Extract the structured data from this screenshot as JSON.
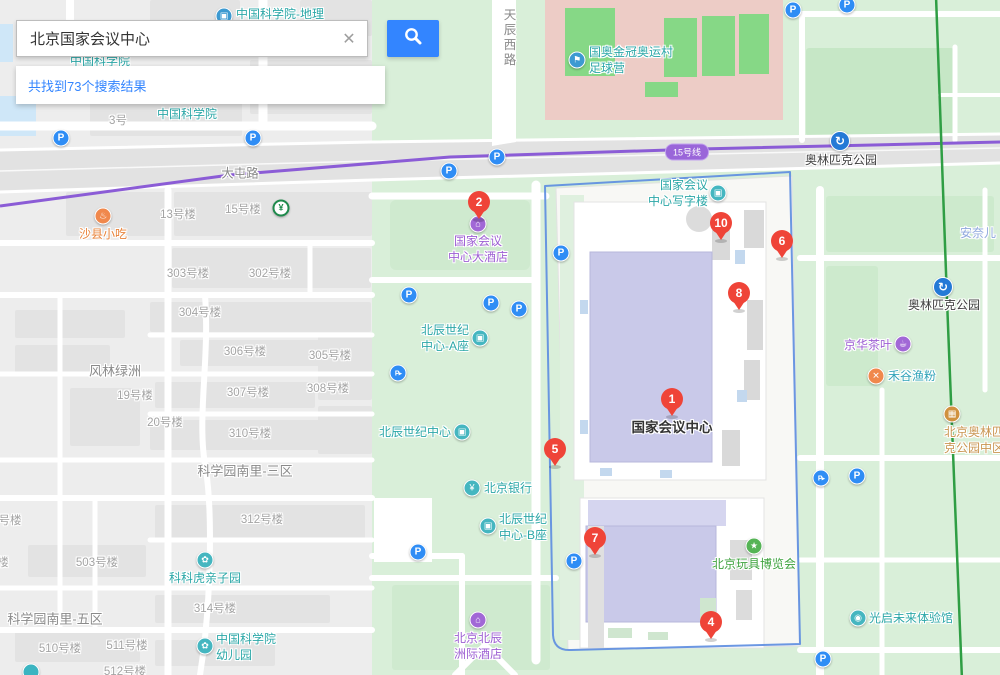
{
  "search": {
    "query": "北京国家会议中心",
    "clear_icon": "✕",
    "button_icon": "magnifier-icon",
    "results_text": "共找到73个搜索结果"
  },
  "map": {
    "subway_badge": "15号线",
    "colors": {
      "accent_blue": "#3385ff",
      "marker_red": "#ef4438",
      "parking_blue": "#2f8df5",
      "metro_blue": "#2479d6",
      "poi_teal": "#2ba7a7",
      "poi_purple": "#9d5fd3",
      "poi_orange": "#e8833a",
      "poi_green": "#3da23d",
      "subway_purple": "#8b5cd6",
      "boundary_blue": "#5b8ce0",
      "rail_green": "#2f9e44"
    },
    "markers": [
      {
        "label": "1",
        "x": 672,
        "y": 399
      },
      {
        "label": "2",
        "x": 479,
        "y": 202
      },
      {
        "label": "4",
        "x": 711,
        "y": 622
      },
      {
        "label": "5",
        "x": 555,
        "y": 449
      },
      {
        "label": "6",
        "x": 782,
        "y": 241
      },
      {
        "label": "7",
        "x": 595,
        "y": 538
      },
      {
        "label": "8",
        "x": 739,
        "y": 293
      },
      {
        "label": "10",
        "x": 721,
        "y": 223
      }
    ],
    "pois": [
      {
        "id": "cas-geography",
        "lines": [
          "中国科学院-地理"
        ],
        "icon": {
          "glyph": "▣",
          "bg": "#3d9ad1",
          "x": 224,
          "y": 16
        },
        "text": {
          "x": 236,
          "y": 14,
          "align": "right",
          "color": "#2ba7a7"
        }
      },
      {
        "id": "cas-institute",
        "lines": [
          "中国科学院"
        ],
        "text": {
          "x": 187,
          "y": 114,
          "align": "center",
          "color": "#2ba7a7"
        }
      },
      {
        "id": "cas-institute-partial",
        "lines": [
          "中国科学院"
        ],
        "text": {
          "x": 100,
          "y": 61,
          "align": "center",
          "color": "#2ba7a7"
        }
      },
      {
        "id": "guoao-soccer-camp",
        "lines": [
          "国奥金冠奥运村",
          "足球营"
        ],
        "icon": {
          "glyph": "⚑",
          "bg": "#3d9ad1",
          "x": 577,
          "y": 60
        },
        "text": {
          "x": 589,
          "y": 60,
          "align": "right",
          "color": "#2ba7a7"
        }
      },
      {
        "id": "olympic-park-station-nw",
        "lines": [
          "奥林匹克公园"
        ],
        "icon": {
          "glyph": "↻",
          "bg": "#2479d6",
          "x": 840,
          "y": 141,
          "metro": true
        },
        "text": {
          "x": 841,
          "y": 152,
          "align": "below",
          "color": "#3c3c3c"
        }
      },
      {
        "id": "olympic-park-station-se",
        "lines": [
          "奥林匹克公园"
        ],
        "icon": {
          "glyph": "↻",
          "bg": "#2479d6",
          "x": 943,
          "y": 287,
          "metro": true
        },
        "text": {
          "x": 944,
          "y": 297,
          "align": "below",
          "color": "#3c3c3c"
        }
      },
      {
        "id": "shaxian-snack",
        "lines": [
          "沙县小吃"
        ],
        "icon": {
          "glyph": "♨",
          "bg": "#f0884c",
          "x": 103,
          "y": 216
        },
        "text": {
          "x": 103,
          "y": 226,
          "align": "below",
          "color": "#e8833a"
        }
      },
      {
        "id": "abc-bank",
        "lines": [],
        "icon": {
          "glyph": "¥",
          "bg": "#fff",
          "x": 281,
          "y": 208,
          "ring": true
        }
      },
      {
        "id": "beichen-century-center-a",
        "lines": [
          "北辰世纪",
          "中心-A座"
        ],
        "icon": {
          "glyph": "▣",
          "bg": "#45b6c0",
          "x": 480,
          "y": 338
        },
        "text": {
          "x": 469,
          "y": 338,
          "align": "left",
          "color": "#2ba7a7"
        }
      },
      {
        "id": "beichen-century-center",
        "lines": [
          "北辰世纪中心"
        ],
        "icon": {
          "glyph": "▣",
          "bg": "#45b6c0",
          "x": 462,
          "y": 432
        },
        "text": {
          "x": 451,
          "y": 432,
          "align": "left",
          "color": "#2ba7a7"
        }
      },
      {
        "id": "bank-of-beijing",
        "lines": [
          "北京银行"
        ],
        "icon": {
          "glyph": "¥",
          "bg": "#45b6c0",
          "x": 472,
          "y": 488
        },
        "text": {
          "x": 484,
          "y": 488,
          "align": "right",
          "color": "#2ba7a7"
        }
      },
      {
        "id": "beichen-century-center-b",
        "lines": [
          "北辰世纪",
          "中心-B座"
        ],
        "icon": {
          "glyph": "▣",
          "bg": "#45b6c0",
          "x": 488,
          "y": 526
        },
        "text": {
          "x": 499,
          "y": 527,
          "align": "right",
          "color": "#2ba7a7"
        }
      },
      {
        "id": "ncc-grand-hotel",
        "lines": [
          "国家会议",
          "中心大酒店"
        ],
        "icon": {
          "glyph": "⌂",
          "bg": "#a168d6",
          "x": 478,
          "y": 224
        },
        "text": {
          "x": 478,
          "y": 233,
          "align": "below",
          "color": "#9d5fd3"
        }
      },
      {
        "id": "ncc-office-tower",
        "lines": [
          "国家会议",
          "中心写字楼"
        ],
        "icon": {
          "glyph": "▣",
          "bg": "#45b6c0",
          "x": 718,
          "y": 193
        },
        "text": {
          "x": 708,
          "y": 193,
          "align": "left",
          "color": "#2ba7a7"
        }
      },
      {
        "id": "ncc-main-label",
        "lines": [
          "国家会议中心"
        ],
        "text": {
          "x": 672,
          "y": 428,
          "align": "center",
          "color": "#333333",
          "size": 13.5,
          "weight": "bold"
        }
      },
      {
        "id": "intercontinental-hotel",
        "lines": [
          "北京北辰",
          "洲际酒店"
        ],
        "icon": {
          "glyph": "⌂",
          "bg": "#a168d6",
          "x": 478,
          "y": 620
        },
        "text": {
          "x": 478,
          "y": 630,
          "align": "below",
          "color": "#9d5fd3"
        }
      },
      {
        "id": "toy-expo",
        "lines": [
          "北京玩具博览会"
        ],
        "icon": {
          "glyph": "★",
          "bg": "#56b456",
          "x": 754,
          "y": 546
        },
        "text": {
          "x": 754,
          "y": 556,
          "align": "below",
          "color": "#3da23d"
        }
      },
      {
        "id": "jinghua-tea",
        "lines": [
          "京华茶叶"
        ],
        "icon": {
          "glyph": "☕",
          "bg": "#a168d6",
          "x": 903,
          "y": 344
        },
        "text": {
          "x": 892,
          "y": 345,
          "align": "left",
          "color": "#9d5fd3"
        }
      },
      {
        "id": "hegu-fish-noodle",
        "lines": [
          "禾谷渔粉"
        ],
        "icon": {
          "glyph": "✕",
          "bg": "#f0884c",
          "x": 876,
          "y": 376
        },
        "text": {
          "x": 888,
          "y": 376,
          "align": "right",
          "color": "#31a3b8"
        }
      },
      {
        "id": "annai-er",
        "lines": [
          "安奈儿"
        ],
        "text": {
          "x": 978,
          "y": 233,
          "align": "center",
          "color": "#8fa8dd"
        }
      },
      {
        "id": "olympic-park-central-zone",
        "lines": [
          "北京奥林匹",
          "克公园中区"
        ],
        "icon": {
          "glyph": "▦",
          "bg": "#d0913f",
          "x": 952,
          "y": 414
        },
        "text": {
          "x": 974,
          "y": 424,
          "align": "below",
          "color": "#c99550"
        }
      },
      {
        "id": "guangqi-future-hall",
        "lines": [
          "光启未来体验馆"
        ],
        "icon": {
          "glyph": "◉",
          "bg": "#45b6c0",
          "x": 858,
          "y": 618
        },
        "text": {
          "x": 869,
          "y": 618,
          "align": "right",
          "color": "#2ba7a7"
        }
      },
      {
        "id": "kekehu-kids-park",
        "lines": [
          "科科虎亲子园"
        ],
        "icon": {
          "glyph": "✿",
          "bg": "#45b6c0",
          "x": 205,
          "y": 560
        },
        "text": {
          "x": 205,
          "y": 570,
          "align": "below",
          "color": "#2ba7a7"
        }
      },
      {
        "id": "cas-kindergarten",
        "lines": [
          "中国科学院",
          "幼儿园"
        ],
        "icon": {
          "glyph": "✿",
          "bg": "#45b6c0",
          "x": 205,
          "y": 646
        },
        "text": {
          "x": 216,
          "y": 647,
          "align": "right",
          "color": "#2ba7a7"
        }
      },
      {
        "id": "poi-partial-bottom",
        "lines": [],
        "icon": {
          "glyph": "",
          "bg": "#3bb4c1",
          "x": 31,
          "y": 672
        }
      }
    ],
    "parking": [
      {
        "x": 61,
        "y": 138
      },
      {
        "x": 253,
        "y": 138
      },
      {
        "x": 449,
        "y": 171
      },
      {
        "x": 497,
        "y": 157
      },
      {
        "x": 561,
        "y": 253
      },
      {
        "x": 793,
        "y": 10
      },
      {
        "x": 847,
        "y": 5
      },
      {
        "x": 409,
        "y": 295
      },
      {
        "x": 491,
        "y": 303
      },
      {
        "x": 519,
        "y": 309
      },
      {
        "x": 418,
        "y": 552
      },
      {
        "x": 574,
        "y": 561
      },
      {
        "x": 857,
        "y": 476
      },
      {
        "x": 823,
        "y": 659
      }
    ],
    "parking_entrance": [
      {
        "x": 398,
        "y": 373
      },
      {
        "x": 821,
        "y": 478
      }
    ],
    "parking_glyph": "P",
    "parking_entrance_glyph": "P▸",
    "road_labels": [
      {
        "text": "大屯路",
        "x": 240,
        "y": 172
      },
      {
        "text": "天辰西路",
        "x": 510,
        "y": 38,
        "vertical": true
      }
    ],
    "area_labels": [
      {
        "text": "风林绿洲",
        "x": 115,
        "y": 370,
        "size": 13
      },
      {
        "text": "科学园南里-三区",
        "x": 245,
        "y": 470,
        "size": 13
      },
      {
        "text": "科学园南里-五区",
        "x": 55,
        "y": 618,
        "size": 13
      }
    ],
    "building_labels": [
      {
        "text": "3号",
        "x": 118,
        "y": 120
      },
      {
        "text": "13号楼",
        "x": 178,
        "y": 214
      },
      {
        "text": "15号楼",
        "x": 243,
        "y": 209
      },
      {
        "text": "303号楼",
        "x": 188,
        "y": 273
      },
      {
        "text": "302号楼",
        "x": 270,
        "y": 273
      },
      {
        "text": "304号楼",
        "x": 200,
        "y": 312
      },
      {
        "text": "306号楼",
        "x": 245,
        "y": 351
      },
      {
        "text": "305号楼",
        "x": 330,
        "y": 355
      },
      {
        "text": "307号楼",
        "x": 248,
        "y": 392
      },
      {
        "text": "308号楼",
        "x": 328,
        "y": 388
      },
      {
        "text": "310号楼",
        "x": 250,
        "y": 433
      },
      {
        "text": "19号楼",
        "x": 135,
        "y": 395
      },
      {
        "text": "20号楼",
        "x": 165,
        "y": 422
      },
      {
        "text": "312号楼",
        "x": 262,
        "y": 519
      },
      {
        "text": "503号楼",
        "x": 97,
        "y": 562
      },
      {
        "text": "314号楼",
        "x": 215,
        "y": 608
      },
      {
        "text": "510号楼",
        "x": 60,
        "y": 648
      },
      {
        "text": "511号楼",
        "x": 127,
        "y": 645
      },
      {
        "text": "512号楼",
        "x": 125,
        "y": 671
      },
      {
        "text": "号楼",
        "x": 10,
        "y": 520
      },
      {
        "text": "楼",
        "x": 3,
        "y": 562
      }
    ]
  }
}
